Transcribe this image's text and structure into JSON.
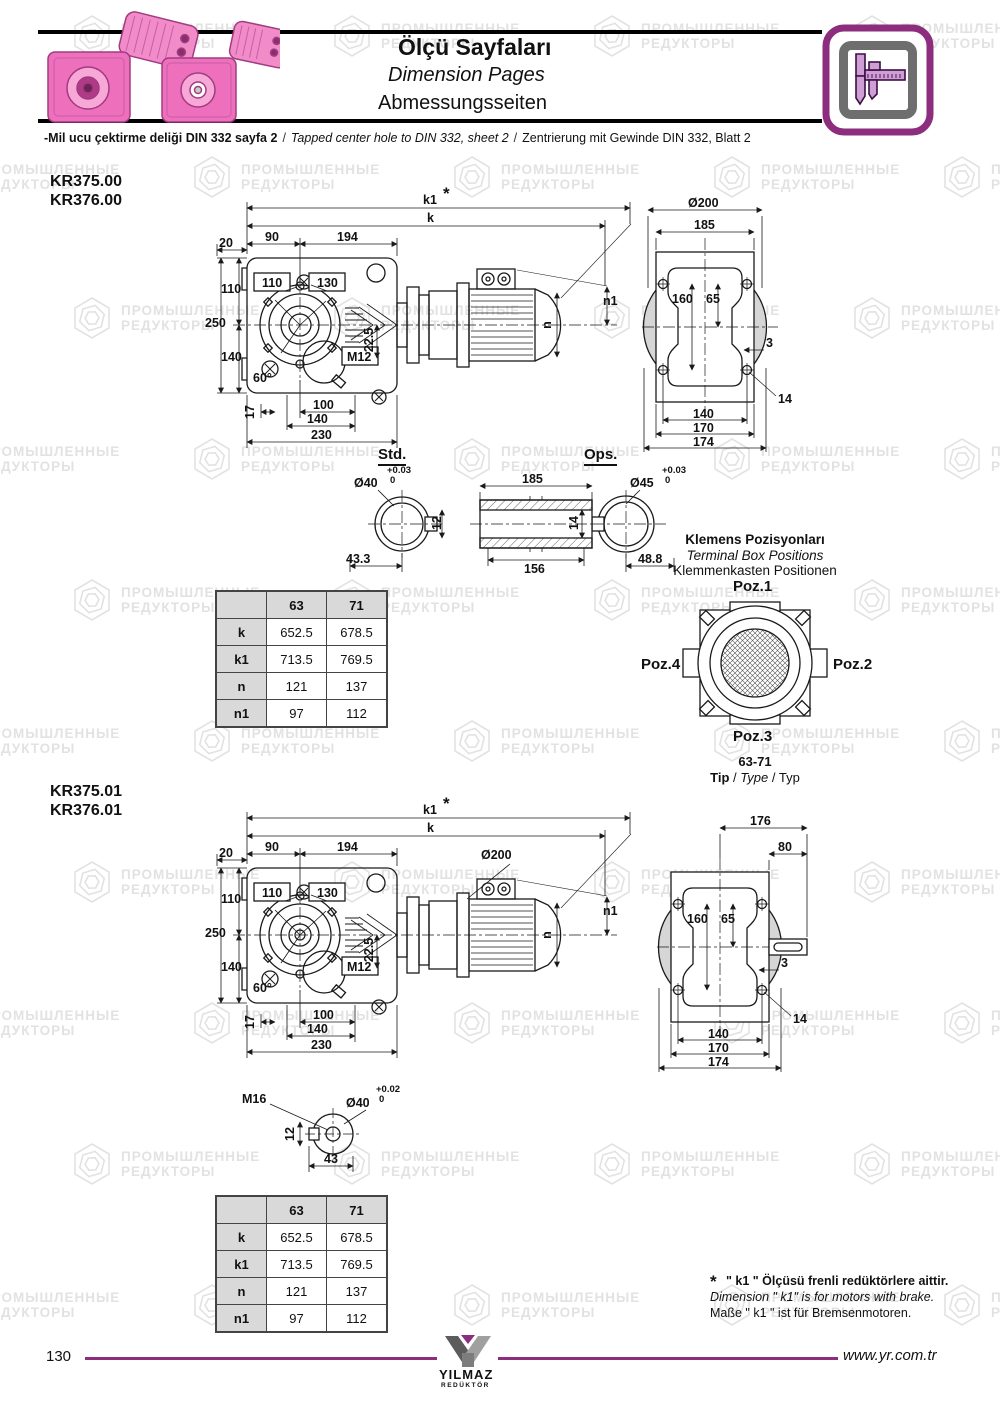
{
  "watermark": {
    "line1": "ПРОМЫШЛЕННЫЕ",
    "line2": "РЕДУКТОРЫ"
  },
  "misc": {
    "slash": "/"
  },
  "header": {
    "title_tr": "Ölçü Sayfaları",
    "title_en": "Dimension Pages",
    "title_de": "Abmessungsseiten",
    "note_tr": "-Mil ucu çektirme deliği DIN 332 sayfa 2",
    "note_en": "Tapped center hole to DIN 332, sheet 2",
    "note_de": "Zentrierung mit Gewinde DIN 332, Blatt 2"
  },
  "section1": {
    "model1": "KR375.00",
    "model2": "KR376.00",
    "front": {
      "k1": "k1",
      "star": "*",
      "k": "k",
      "d90": "90",
      "d194": "194",
      "d20": "20",
      "c110": "110",
      "c130": "130",
      "d110": "110",
      "d250": "250",
      "d140": "140",
      "a60": "60°",
      "m12": "M12",
      "d22_5": "22.5",
      "d17": "17",
      "d100": "100",
      "d140b": "140",
      "d230": "230",
      "n": "n",
      "n1": "n1"
    },
    "side": {
      "d200": "Ø200",
      "d185": "185",
      "d160": "160",
      "d65": "65",
      "d3": "3",
      "d14": "14",
      "d140": "140",
      "d170": "170",
      "d174": "174"
    }
  },
  "stdops": {
    "std": "Std.",
    "ops": "Ops.",
    "d40": "Ø40",
    "tolhi": "+0.03",
    "tollo": "0",
    "d12": "12",
    "d433": "43.3",
    "d185": "185",
    "d156": "156",
    "d14": "14",
    "d45": "Ø45",
    "tolhi2": "+0.03",
    "tollo2": "0",
    "d488": "48.8"
  },
  "table1": {
    "col1": "63",
    "col2": "71",
    "rows": [
      {
        "h": "k",
        "v1": "652.5",
        "v2": "678.5"
      },
      {
        "h": "k1",
        "v1": "713.5",
        "v2": "769.5"
      },
      {
        "h": "n",
        "v1": "121",
        "v2": "137"
      },
      {
        "h": "n1",
        "v1": "97",
        "v2": "112"
      }
    ]
  },
  "terminal": {
    "t_tr": "Klemens Pozisyonları",
    "t_en": "Terminal Box Positions",
    "t_de": "Klemmenkasten Positionen",
    "poz1": "Poz.1",
    "poz2": "Poz.2",
    "poz3": "Poz.3",
    "poz4": "Poz.4",
    "size": "63-71",
    "tip_tr": "Tip",
    "tip_en": "Type",
    "tip_de": "Typ"
  },
  "section2": {
    "model1": "KR375.01",
    "model2": "KR376.01",
    "front": {
      "k1": "k1",
      "star": "*",
      "k": "k",
      "d90": "90",
      "d194": "194",
      "d20": "20",
      "d200": "Ø200",
      "c110": "110",
      "c130": "130",
      "d110": "110",
      "d250": "250",
      "d140": "140",
      "a60": "60°",
      "m12": "M12",
      "d22_5": "22.5",
      "d17": "17",
      "d100": "100",
      "d140b": "140",
      "d230": "230",
      "n": "n",
      "n1": "n1"
    },
    "side": {
      "d176": "176",
      "d80": "80",
      "d160": "160",
      "d65": "65",
      "d3": "3",
      "d14": "14",
      "d140": "140",
      "d170": "170",
      "d174": "174"
    }
  },
  "shaft01": {
    "m16": "M16",
    "d40": "Ø40",
    "tolhi": "+0.02",
    "tollo": "0",
    "d12": "12",
    "d43": "43"
  },
  "table2": {
    "col1": "63",
    "col2": "71",
    "rows": [
      {
        "h": "k",
        "v1": "652.5",
        "v2": "678.5"
      },
      {
        "h": "k1",
        "v1": "713.5",
        "v2": "769.5"
      },
      {
        "h": "n",
        "v1": "121",
        "v2": "137"
      },
      {
        "h": "n1",
        "v1": "97",
        "v2": "112"
      }
    ]
  },
  "footnote": {
    "star": "*",
    "tr": "\" k1 \" Ölçüsü frenli redüktörlere aittir.",
    "en": "Dimension \" k1\" is for motors with brake.",
    "de": "Maße \" k1 \" ist für Bremsenmotoren."
  },
  "footer": {
    "page": "130",
    "logo1": "YILMAZ",
    "logo2": "REDÜKTÖR",
    "url": "www.yr.com.tr"
  },
  "colors": {
    "accent": "#8c2d7e",
    "pink": "#ee6fbc",
    "table_gray": "#d9d9d9",
    "watermark_gray": "#e2e2e2"
  }
}
